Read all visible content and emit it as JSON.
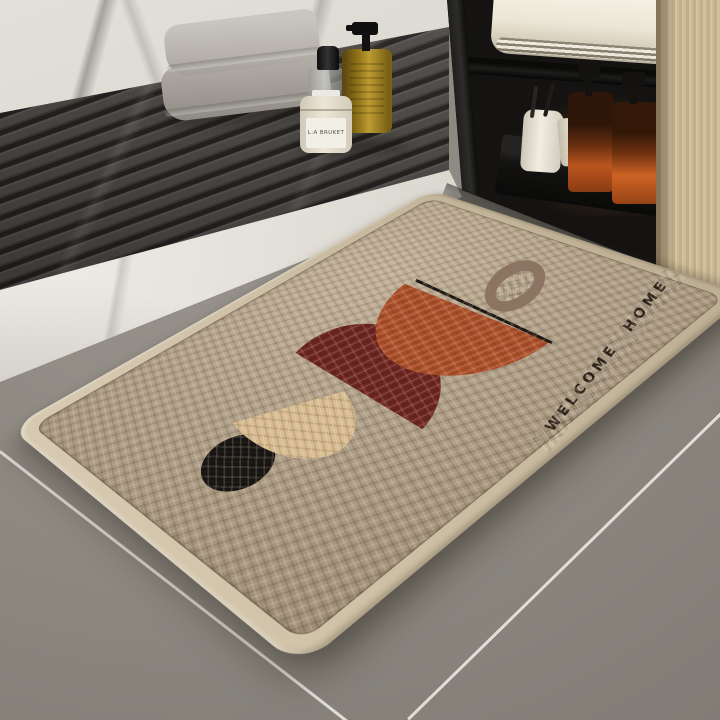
{
  "scene": {
    "description": "Bathroom product photo of a woven diatomite doormat beside a shower tray and black vanity cabinet",
    "floor_color": "#8c8880",
    "grout_color": "#e9e6df"
  },
  "mat": {
    "text": "WELCOME HOME",
    "text_color": "#2b2219",
    "weave_color": "#b3a28a",
    "border_color": "#c9bba0",
    "shapes": [
      {
        "name": "black-circle",
        "color": "#181512"
      },
      {
        "name": "beige-semicircle",
        "color": "#d9bc90"
      },
      {
        "name": "maroon-semicircle",
        "color": "#6e2420"
      },
      {
        "name": "rust-semicircle",
        "color": "#ad4f28"
      },
      {
        "name": "accent-line",
        "color": "#1c1812"
      },
      {
        "name": "taupe-ring",
        "color": "#8b7462"
      }
    ]
  },
  "shower_area": {
    "wall_color": "#dcd9d3",
    "slat_color": "#3f3d3a",
    "threshold_color": "#e9e6e0",
    "towel_color": "#b3afa8",
    "jar_label": "L:A BRUKET",
    "items": [
      "folded-gray-towels",
      "glass-bottle",
      "amber-soap-dispenser",
      "cream-jar"
    ]
  },
  "cabinet": {
    "frame_color": "#141312",
    "wood_color": "#cbb894",
    "towel_color": "#ece6d6",
    "items": [
      "folded-white-towel",
      "toothbrush-cup",
      "toothbrushes",
      "cosmetic-tube",
      "amber-pump-bottle-1",
      "amber-pump-bottle-2",
      "green-bottle",
      "white-jar"
    ]
  }
}
